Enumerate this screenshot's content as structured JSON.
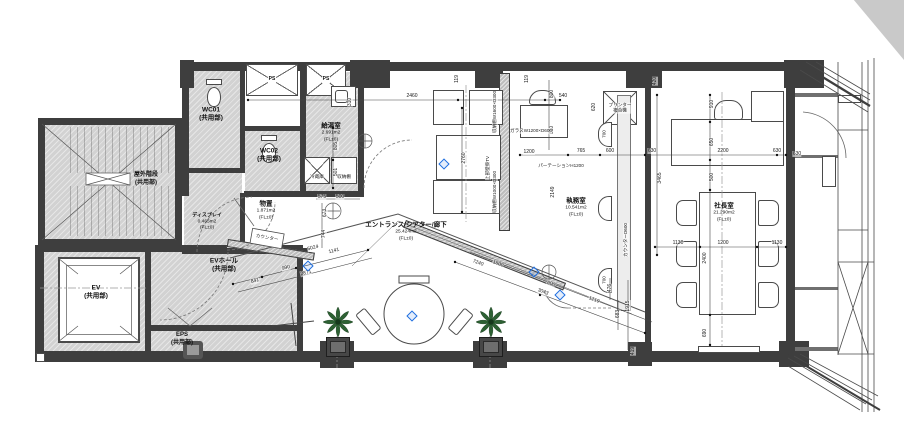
{
  "plan": {
    "rooms": {
      "wc01": {
        "name": "WC01",
        "sub": "(共用部)"
      },
      "wc02": {
        "name": "WC02",
        "sub": "(共用部)"
      },
      "ps1": {
        "name": "PS"
      },
      "ps2": {
        "name": "PS"
      },
      "kyutou": {
        "name": "給湯室",
        "area": "2.691m2",
        "level": "(FL±0)"
      },
      "display": {
        "name": "ディスプレイ",
        "area": "0.465m2",
        "level": "(FL±0)"
      },
      "monooki": {
        "name": "物置",
        "area": "1.871m2",
        "level": "(FL±0)"
      },
      "entrance": {
        "name": "エントランス/シアター/廊下",
        "area": "25.424m2",
        "level": "(FL±0)"
      },
      "shitsumu": {
        "name": "執務室",
        "area": "10.541m2",
        "level": "(FL±0)"
      },
      "shacho": {
        "name": "社長室",
        "area": "21.290m2",
        "level": "(FL±0)"
      },
      "okugai": {
        "name": "屋外階段",
        "sub": "(共用部)"
      },
      "ev": {
        "name": "EV",
        "sub": "(共用部)"
      },
      "evhall": {
        "name": "EVホール",
        "sub": "(共用部)"
      },
      "eps": {
        "name": "EPS",
        "sub": "(共用部)"
      }
    },
    "annotations": [
      {
        "text": "ガラスW1200×D600",
        "x": 531,
        "y": 131,
        "r": 0
      },
      {
        "text": "パーテーションH1200",
        "x": 561,
        "y": 166,
        "r": 0
      },
      {
        "text": "収納棚W1600×D300",
        "x": 495,
        "y": 112,
        "r": -90
      },
      {
        "text": "収納棚W1000×D300",
        "x": 495,
        "y": 192,
        "r": -90
      },
      {
        "text": "上部壁掛TV",
        "x": 488,
        "y": 168,
        "r": -90
      },
      {
        "text": "カウンターD600",
        "x": 626,
        "y": 240,
        "r": -90
      },
      {
        "text": "冷蔵庫",
        "x": 317,
        "y": 177,
        "r": 0
      },
      {
        "text": "収納棚",
        "x": 344,
        "y": 177,
        "r": 0
      },
      {
        "text": "プリンター複合機",
        "x": 620,
        "y": 108,
        "r": 0,
        "w": 26
      },
      {
        "text": "カウンター",
        "x": 267,
        "y": 238,
        "r": 10
      },
      {
        "text": "700",
        "x": 604,
        "y": 134,
        "r": -90
      },
      {
        "text": "700",
        "x": 604,
        "y": 280,
        "r": -90
      }
    ],
    "dimensions": [
      {
        "t": "2460",
        "x": 412,
        "y": 96,
        "r": 0
      },
      {
        "t": "540",
        "x": 563,
        "y": 96,
        "r": 0
      },
      {
        "t": "310",
        "x": 350,
        "y": 102,
        "r": -90
      },
      {
        "t": "119",
        "x": 457,
        "y": 79,
        "r": -90
      },
      {
        "t": "119",
        "x": 527,
        "y": 79,
        "r": -90
      },
      {
        "t": "800",
        "x": 552,
        "y": 94,
        "r": -90
      },
      {
        "t": "650",
        "x": 552,
        "y": 130,
        "r": -90
      },
      {
        "t": "620",
        "x": 594,
        "y": 107,
        "r": -90
      },
      {
        "t": "420",
        "x": 655,
        "y": 81,
        "r": -90
      },
      {
        "t": "910",
        "x": 712,
        "y": 104,
        "r": -90
      },
      {
        "t": "650",
        "x": 712,
        "y": 142,
        "r": -90
      },
      {
        "t": "500",
        "x": 712,
        "y": 177,
        "r": -90
      },
      {
        "t": "630",
        "x": 652,
        "y": 151,
        "r": 0
      },
      {
        "t": "2200",
        "x": 723,
        "y": 151,
        "r": 0
      },
      {
        "t": "630",
        "x": 777,
        "y": 151,
        "r": 0
      },
      {
        "t": "1130",
        "x": 678,
        "y": 243,
        "r": 0
      },
      {
        "t": "1200",
        "x": 723,
        "y": 243,
        "r": 0
      },
      {
        "t": "1130",
        "x": 777,
        "y": 243,
        "r": 0
      },
      {
        "t": "2400",
        "x": 705,
        "y": 258,
        "r": -90
      },
      {
        "t": "690",
        "x": 705,
        "y": 333,
        "r": -90
      },
      {
        "t": "3465",
        "x": 660,
        "y": 178,
        "r": -90
      },
      {
        "t": "765",
        "x": 581,
        "y": 151,
        "r": 0
      },
      {
        "t": "600",
        "x": 610,
        "y": 151,
        "r": 0
      },
      {
        "t": "1200",
        "x": 529,
        "y": 152,
        "r": 0
      },
      {
        "t": "2149",
        "x": 553,
        "y": 192,
        "r": -90
      },
      {
        "t": "2760",
        "x": 464,
        "y": 158,
        "r": -90
      },
      {
        "t": "805",
        "x": 336,
        "y": 146,
        "r": -90
      },
      {
        "t": "501",
        "x": 336,
        "y": 172,
        "r": -90
      },
      {
        "t": "575",
        "x": 322,
        "y": 197,
        "r": 0
      },
      {
        "t": "500",
        "x": 340,
        "y": 197,
        "r": 0
      },
      {
        "t": "673",
        "x": 325,
        "y": 213,
        "r": -90
      },
      {
        "t": "744",
        "x": 324,
        "y": 234,
        "r": -90
      },
      {
        "t": "841",
        "x": 255,
        "y": 281,
        "r": -14
      },
      {
        "t": "990",
        "x": 286,
        "y": 268,
        "r": -14
      },
      {
        "t": "2871",
        "x": 306,
        "y": 273,
        "r": -14
      },
      {
        "t": "5024",
        "x": 313,
        "y": 248,
        "r": -14
      },
      {
        "t": "1141",
        "x": 334,
        "y": 251,
        "r": -14
      },
      {
        "t": "7240",
        "x": 478,
        "y": 263,
        "r": 21
      },
      {
        "t": "1500",
        "x": 498,
        "y": 264,
        "r": 21
      },
      {
        "t": "600",
        "x": 551,
        "y": 284,
        "r": 21
      },
      {
        "t": "3043",
        "x": 543,
        "y": 292,
        "r": 21
      },
      {
        "t": "1219",
        "x": 594,
        "y": 300,
        "r": 21
      },
      {
        "t": "476",
        "x": 610,
        "y": 288,
        "r": -90
      },
      {
        "t": "683",
        "x": 618,
        "y": 314,
        "r": -90
      },
      {
        "t": "1915",
        "x": 628,
        "y": 306,
        "r": -90
      },
      {
        "t": "419",
        "x": 633,
        "y": 351,
        "r": -90
      },
      {
        "t": "630",
        "x": 797,
        "y": 154,
        "r": 0
      }
    ],
    "level_markers": [
      {
        "x": 444,
        "y": 164
      },
      {
        "x": 308,
        "y": 266
      },
      {
        "x": 412,
        "y": 316
      },
      {
        "x": 560,
        "y": 295
      },
      {
        "x": 534,
        "y": 272
      }
    ],
    "colors": {
      "wall": "#3e3e3e",
      "hatch": "#d2d2d2",
      "line": "#555555",
      "marker_blue": "#1f6fe0",
      "plant_green": "#2d6133"
    }
  }
}
